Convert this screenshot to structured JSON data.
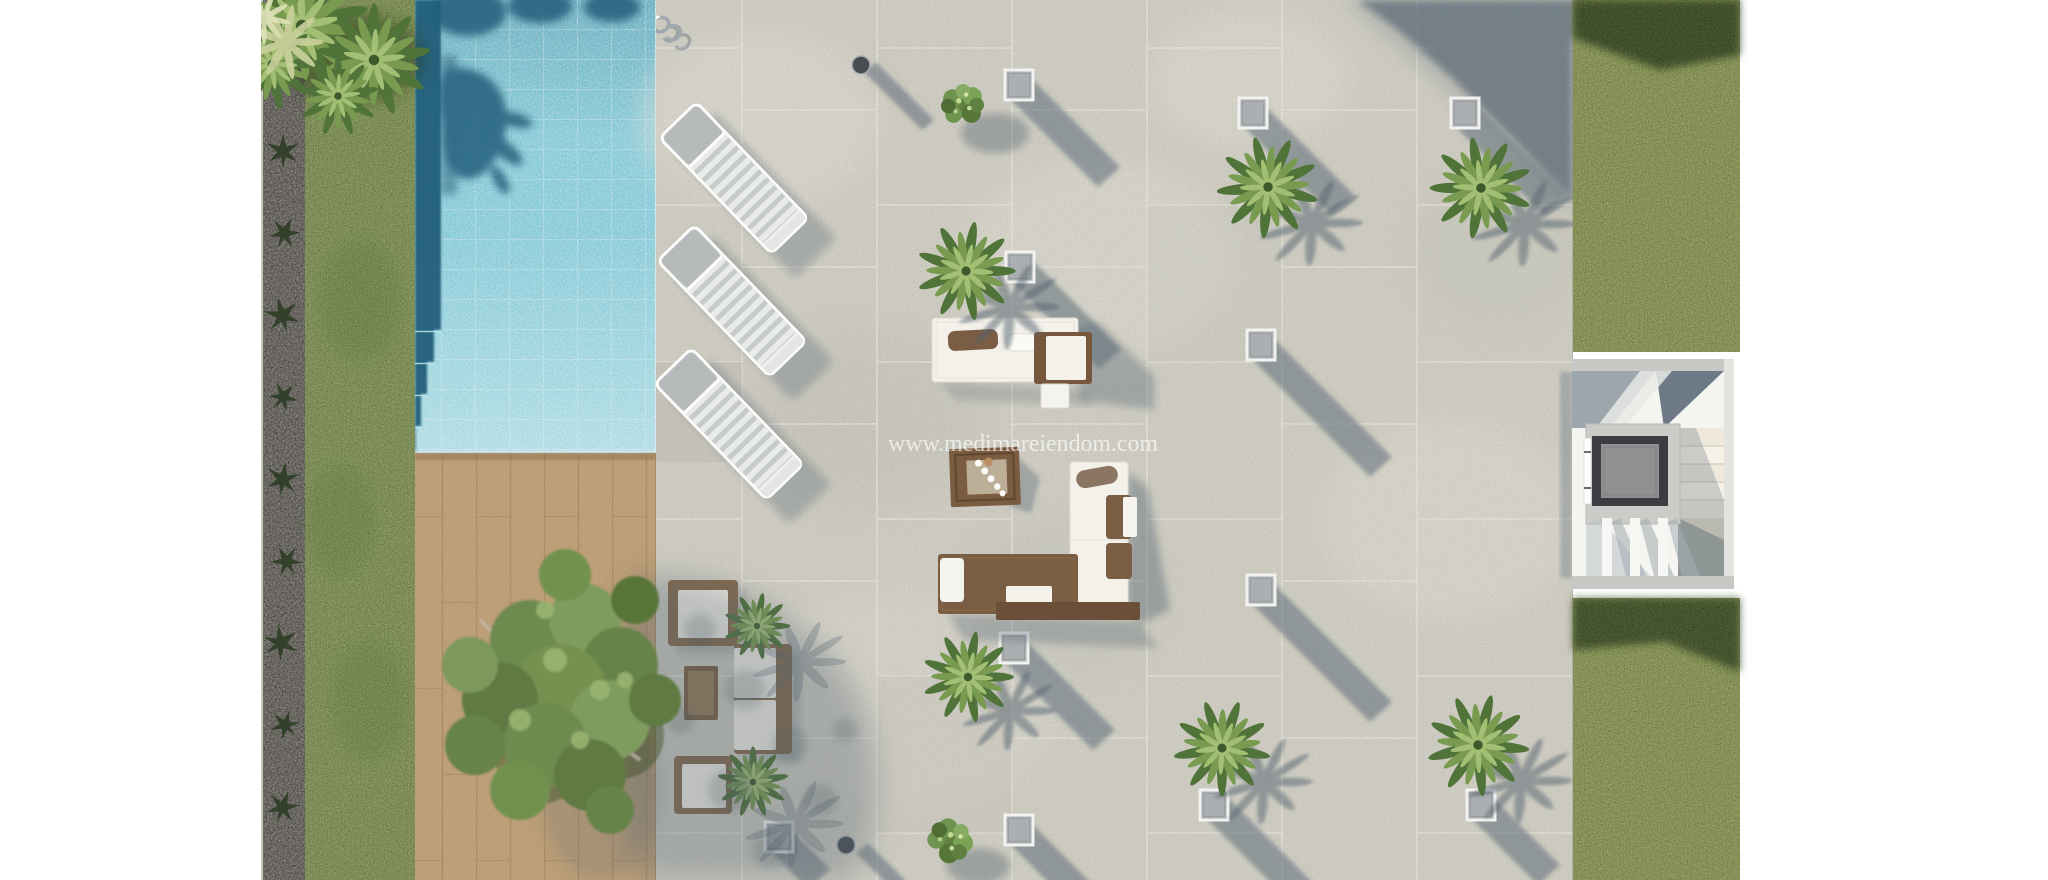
{
  "watermark": {
    "text": "www.medimareiendom.com"
  },
  "colors": {
    "background": "#ffffff",
    "pool_water": "#86d1e0",
    "pool_shadow": "#235e7c",
    "grass_left": "#8da15e",
    "grass_right": "#98a65f",
    "grass_shadow": "#2f431f",
    "gravel": "#6e6a62",
    "deck_wood": "#c3a47c",
    "patio_tile": "#d2d0c5",
    "cast_shadow": "#5d6c78",
    "skylight_fill": "#abafb1",
    "skylight_border": "#f2f2f0",
    "lounger_head": "#b6babb",
    "wicker_brown": "#84694d",
    "cushion_white": "#f2efe7",
    "sofa_brown": "#7a5d43",
    "daybed_white": "#f3f1ea",
    "stair_gray": "#c8c9c5",
    "elevator_frame": "#3b3d40",
    "elevator_cab": "#8e9092",
    "palm_green": "#4f7338",
    "tree_green": "#74904f"
  },
  "scene": {
    "view": "top-down architectural render of a villa terrace and garden",
    "areas": {
      "pool": "swimming pool with shaded edge and corner steps, top left",
      "deck": "wooden deck with large tree in planter, bottom left",
      "terrace": "large stone-tile terrace with lounge furniture",
      "garden_left": "artificial grass strip with gravel border and palm bush",
      "garden_right": "two grass strips on the right edge",
      "stairwell": "open stairwell with elevator shaft, middle right"
    },
    "counts": {
      "sun_loungers": 3,
      "skylights": 11,
      "palm_trees": 6,
      "shrubs": 2,
      "seating_groups": 3,
      "bollard_lights": 2
    }
  }
}
